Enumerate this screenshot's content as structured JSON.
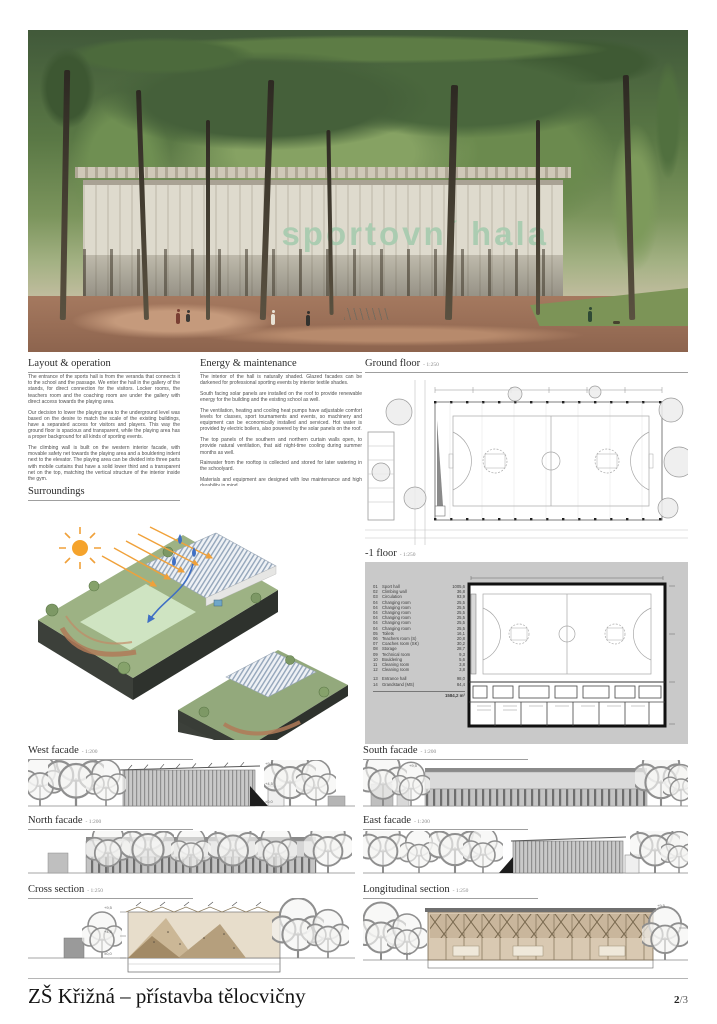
{
  "render": {
    "building_sign": "sportovní hala"
  },
  "sections": {
    "layout": {
      "title": "Layout & operation",
      "paragraphs": [
        "The entrance of the sports hall is from the veranda that connects it to the school and the passage. We enter the hall in the gallery of the stands, for direct connection for the visitors. Locker rooms, the teachers room and the coaching room are under the gallery with direct access towards the playing area.",
        "Our decision to lower the playing area to the underground level was based on the desire to match the scale of the existing buildings, have a separated access for visitors and players. This way the ground floor is spacious and transparent, while the playing area has a proper background for all kinds of sporting events.",
        "The climbing wall is built on the western interior facade, with movable safety net towards the playing area and a bouldering indent next to the elevator. The playing area can be divided into three parts with mobile curtains that have a solid lower third and a transparent net on the top, matching the vertical structure of the interior inside the gym.",
        "The teachers room and the coaching room both have openings towards the playing area, with lecterns in the wall that serve as benches for the PE classes and protection of the windows. Storage spaces are directly accessible from the hall."
      ]
    },
    "energy": {
      "title": "Energy & maintenance",
      "paragraphs": [
        "The interior of the hall is naturally shaded. Glazed facades can be darkened for professional sporting events by interior textile shades.",
        "South facing solar panels are installed on the roof to provide renewable energy for the building and the existing school as well.",
        "The ventilation, heating and cooling heat pumps have adjustable comfort levels for classes, sport tournaments and events, so machinery and equipment can be economically installed and serviced. Hot water is provided by electric boilers, also powered by the solar panels on the roof.",
        "The top panels of the southern and northern curtain walls open, to provide natural ventilation, that aid night-time cooling during summer months as well.",
        "Rainwater from the rooftop is collected and stored for later watering in the schoolyard.",
        "Materials and equipment are designed with low maintenance and high durability in mind."
      ]
    },
    "surroundings": {
      "title": "Surroundings"
    },
    "ground_floor": {
      "title": "Ground floor",
      "scale": "- 1:250"
    },
    "minus1_floor": {
      "title": "-1 floor",
      "scale": "- 1:250"
    },
    "west_facade": {
      "title": "West facade",
      "scale": "- 1:200"
    },
    "south_facade": {
      "title": "South facade",
      "scale": "- 1:200"
    },
    "north_facade": {
      "title": "North facade",
      "scale": "- 1:200"
    },
    "east_facade": {
      "title": "East facade",
      "scale": "- 1:200"
    },
    "cross_section": {
      "title": "Cross section",
      "scale": "- 1:250"
    },
    "long_section": {
      "title": "Longitudinal section",
      "scale": "- 1:250"
    }
  },
  "legend": {
    "rows": [
      {
        "no": "01",
        "name": "Sport hall",
        "area": "1005,6"
      },
      {
        "no": "02",
        "name": "Climbing wall",
        "area": "36,8"
      },
      {
        "no": "03",
        "name": "Circulation",
        "area": "93,9"
      },
      {
        "no": "04",
        "name": "Changing room",
        "area": "25,5"
      },
      {
        "no": "04",
        "name": "Changing room",
        "area": "25,5"
      },
      {
        "no": "04",
        "name": "Changing room",
        "area": "25,5"
      },
      {
        "no": "04",
        "name": "Changing room",
        "area": "25,5"
      },
      {
        "no": "04",
        "name": "Changing room",
        "area": "25,5"
      },
      {
        "no": "04",
        "name": "Changing room",
        "area": "25,5"
      },
      {
        "no": "05",
        "name": "Toilets",
        "area": "16,1"
      },
      {
        "no": "06",
        "name": "Teachers room (S)",
        "area": "20,8"
      },
      {
        "no": "07",
        "name": "Coaches room (SK)",
        "area": "30,2"
      },
      {
        "no": "08",
        "name": "Storage",
        "area": "28,7"
      },
      {
        "no": "09",
        "name": "Technical room",
        "area": "9,3"
      },
      {
        "no": "10",
        "name": "Bouldering",
        "area": "5,6"
      },
      {
        "no": "11",
        "name": "Cleaning room",
        "area": "3,8"
      },
      {
        "no": "12",
        "name": "Cleaning room",
        "area": "3,8"
      }
    ],
    "extra_rows": [
      {
        "no": "13",
        "name": "Entrance hall",
        "area": "98,0"
      },
      {
        "no": "14",
        "name": "Grandstand (MS)",
        "area": "84,4"
      }
    ],
    "total": "1584,2 m²"
  },
  "levels": {
    "top": "+9,5",
    "mid": "+4,5",
    "zero": "±0,0"
  },
  "footer": {
    "title": "ZŠ Křižná – přístavba tělocvičny",
    "page_current": "2",
    "page_suffix": "/3"
  },
  "colors": {
    "accent_green": "#a9ccb0",
    "canopy_green": "#4c6a3c",
    "ground_red": "#a5795f",
    "sun_orange": "#f0a13a",
    "rain_blue": "#3f6fc4",
    "plan_grey": "#c9c9c9"
  }
}
